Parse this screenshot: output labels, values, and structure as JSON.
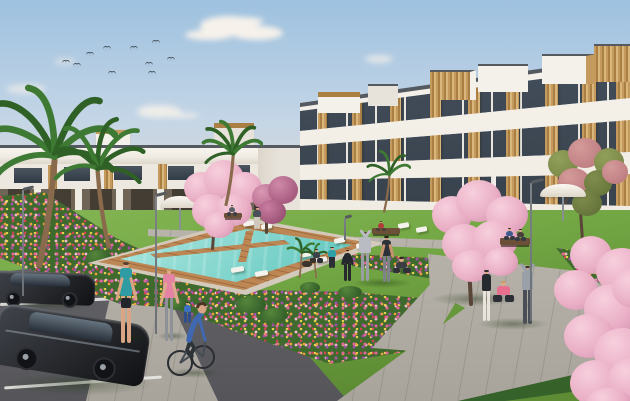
{
  "meta": {
    "description": "Photorealistic architectural render of a modern white residential complex with timber-clad accents, communal lawn, swimming pool, flower beds, cherry-blossom trees, palms, parking area, pedestrians, joggers and a cyclist under a clear morning sky"
  },
  "palette": {
    "sky-top": "#9ec1df",
    "sky-mid": "#c3d5e6",
    "sky-low": "#e2dcd4",
    "horizon": "#efdfce",
    "cloud": "#f6f1ea",
    "bldg-white": "#f4f1ea",
    "bldg-shade": "#e7e2da",
    "coping": "#545a60",
    "glass-a": "#46525f",
    "glass-b": "#2c343d",
    "mullion": "#e8e6df",
    "wood-a": "#c59a5e",
    "wood-b": "#a97f43",
    "wood-c": "#d9b67c",
    "ground-dk": "#3e382f",
    "lawn-a": "#84b554",
    "lawn-b": "#74a845",
    "lawn-c": "#5d8c34",
    "hedge": "#35612a",
    "pool-a": "#bdeee8",
    "pool-b": "#7fd6cd",
    "pool-c": "#49beb5",
    "pool-d": "#2fa49c",
    "deck-a": "#bd8755",
    "deck-b": "#a06c3e",
    "stone": "#d3cabb",
    "path": "#b7b3aa",
    "asphalt-a": "#8a8a8c",
    "asphalt-b": "#6a6a6e",
    "asphalt-c": "#56565a",
    "pline": "#e9e9e4",
    "white": "#f4f2ec",
    "blossom": "#eab0c6",
    "blossom-hi": "#f7cfdd",
    "blossom-dk": "#d28fae",
    "blossom2-g": "#7d8a4a",
    "blossom2-p": "#c08083",
    "palm-a": "#3e7a33",
    "palm-b": "#2f6127",
    "trunk": "#8a6a4c",
    "flw-base": "#3f6a2e",
    "skin": "#d9a584",
    "car-dk": "#26282c",
    "car-md": "#41454c",
    "glasshouse": "#66747f",
    "lamp": "#6b7076",
    "bench": "#6b4f36",
    "cyc-top": "#3f68b0",
    "cyc-bottom": "#2e3338"
  },
  "scene": {
    "sky": {
      "birds": [
        [
          62,
          60
        ],
        [
          73,
          63
        ],
        [
          103,
          46
        ],
        [
          108,
          71
        ],
        [
          130,
          46
        ],
        [
          145,
          62
        ],
        [
          148,
          71
        ],
        [
          167,
          57
        ],
        [
          152,
          40
        ],
        [
          86,
          52
        ]
      ],
      "cloud_count": 5
    },
    "buildings": {
      "right_block": {
        "floors": 3,
        "penthouses": 6,
        "materials": [
          "white-render",
          "tinted-glass",
          "timber-cladding"
        ]
      },
      "left_townhouses": {
        "floors": 2,
        "materials": [
          "white-render",
          "timber-cladding"
        ]
      }
    },
    "pool": {
      "shape": "rectangular-perspective",
      "deck": "timber",
      "loungers": 10,
      "parasols": 2
    },
    "vegetation": {
      "palm_trees": 6,
      "blossom_trees": 5,
      "flower_beds": 4,
      "hedges": 5,
      "bushes": 8
    },
    "vehicles": {
      "parked_cars": 2,
      "bicycles": 1
    },
    "street_lamps": 4,
    "benches": 3,
    "people": [
      {
        "role": "jogger teal top",
        "top": "#2f9ba2",
        "bottom": "#22252a",
        "skin": "#d9a584",
        "hair": "#5a4030"
      },
      {
        "role": "jogger pink top",
        "top": "#e583a4",
        "bottom": "#8e9298",
        "skin": "#dcab8c",
        "hair": "#c89c62"
      },
      {
        "role": "child in blue",
        "top": "#3d6fc2",
        "bottom": "#2f4e8c",
        "skin": "#d9a584",
        "hair": "#3a2e24"
      },
      {
        "role": "walker on promenade",
        "top": "#4a4f57",
        "bottom": "#cfc8bc",
        "skin": "#d9a584",
        "hair": "#2f2a26"
      },
      {
        "role": "bench sitter left",
        "top": "#5a6068",
        "bottom": "#3a3f45",
        "skin": "#d9a584",
        "hair": "#332a22"
      },
      {
        "role": "seated owner with dog",
        "top": "#3c424a",
        "bottom": "#2c3036",
        "skin": "#d9a584",
        "hair": "#2e2620"
      },
      {
        "role": "exerciser teal top",
        "top": "#2fa0a8",
        "bottom": "#2b2f35",
        "skin": "#d9a584",
        "hair": "#463522"
      },
      {
        "role": "exerciser in black",
        "top": "#26292e",
        "bottom": "#26292e",
        "skin": "#d9a584",
        "hair": "#1d1a17"
      },
      {
        "role": "stretcher in gray",
        "top": "#b9bcc2",
        "bottom": "#9a9da3",
        "skin": "#d9a584",
        "hair": "#5a4636"
      },
      {
        "role": "man in dark tank",
        "top": "#2d3138",
        "bottom": "#7d8288",
        "skin": "#c8936f",
        "hair": "#241e18"
      },
      {
        "role": "seated meditator",
        "top": "#3a3e44",
        "bottom": "#2e3238",
        "skin": "#d9a584",
        "hair": "#2a231d"
      },
      {
        "role": "bench sitter red",
        "top": "#b23a3a",
        "bottom": "#4a3f3a",
        "skin": "#d9a584",
        "hair": "#332a22"
      },
      {
        "role": "bench pair blue",
        "top": "#3e5a8e",
        "bottom": "#343944",
        "skin": "#d9a584",
        "hair": "#2f2a26"
      },
      {
        "role": "bench pair brown",
        "top": "#4a3f3a",
        "bottom": "#343944",
        "skin": "#d9a584",
        "hair": "#241e18"
      },
      {
        "role": "trio standing",
        "top": "#26292e",
        "bottom": "#e8e4dc",
        "skin": "#d9a584",
        "hair": "#2f2a26"
      },
      {
        "role": "trio seated pink",
        "top": "#e86f8e",
        "bottom": "#2c3036",
        "skin": "#dcab8c",
        "hair": "#c89c62"
      },
      {
        "role": "trio arms raised gray",
        "top": "#9aa0a8",
        "bottom": "#4a4f57",
        "skin": "#d9a584",
        "hair": "#3a2e26"
      }
    ]
  }
}
